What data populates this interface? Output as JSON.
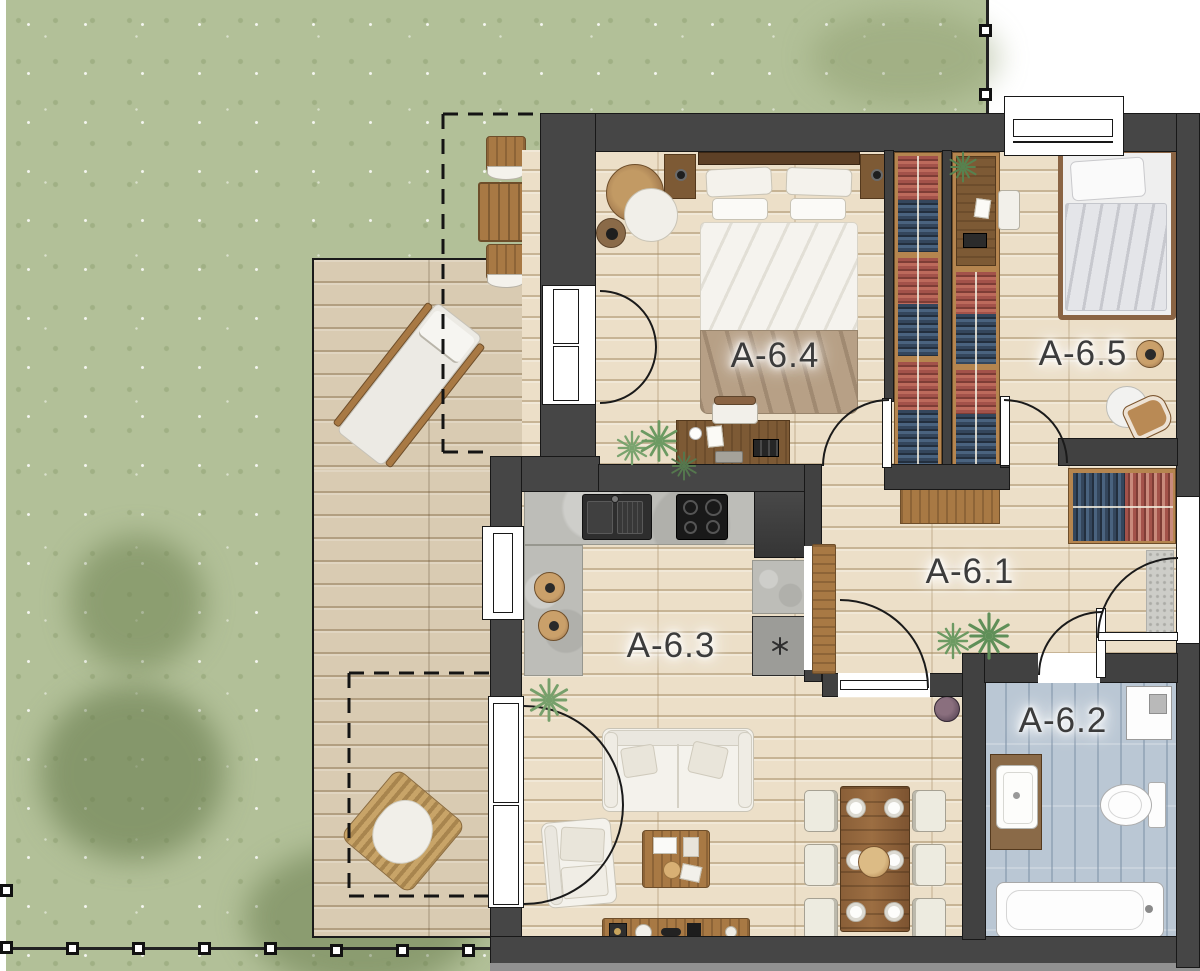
{
  "plan": {
    "rooms": {
      "hall": {
        "label": "A-6.1",
        "type": "hallway"
      },
      "bathroom": {
        "label": "A-6.2",
        "type": "bathroom"
      },
      "living_kitchen": {
        "label": "A-6.3",
        "type": "kitchen-living-room"
      },
      "bedroom_main": {
        "label": "A-6.4",
        "type": "bedroom"
      },
      "bedroom_small": {
        "label": "A-6.5",
        "type": "bedroom"
      }
    },
    "outdoor_features": [
      "garden",
      "wood-deck",
      "sun-lounger",
      "bistro-set",
      "bean-bag",
      "fence"
    ],
    "palette": {
      "grass": "#b2c098",
      "deck_wood": "#d9cbb2",
      "interior_floor": "#ecdfc8",
      "wall": "#464646",
      "bathroom_tile": "#bac7d4",
      "counter_concrete": "#bdbdb8",
      "wood_dark": "#7d5a35",
      "wood_mid": "#a87944",
      "clothes_navy": "#34465c",
      "clothes_red": "#a3524a",
      "label_text": "#3c3c3c"
    }
  }
}
